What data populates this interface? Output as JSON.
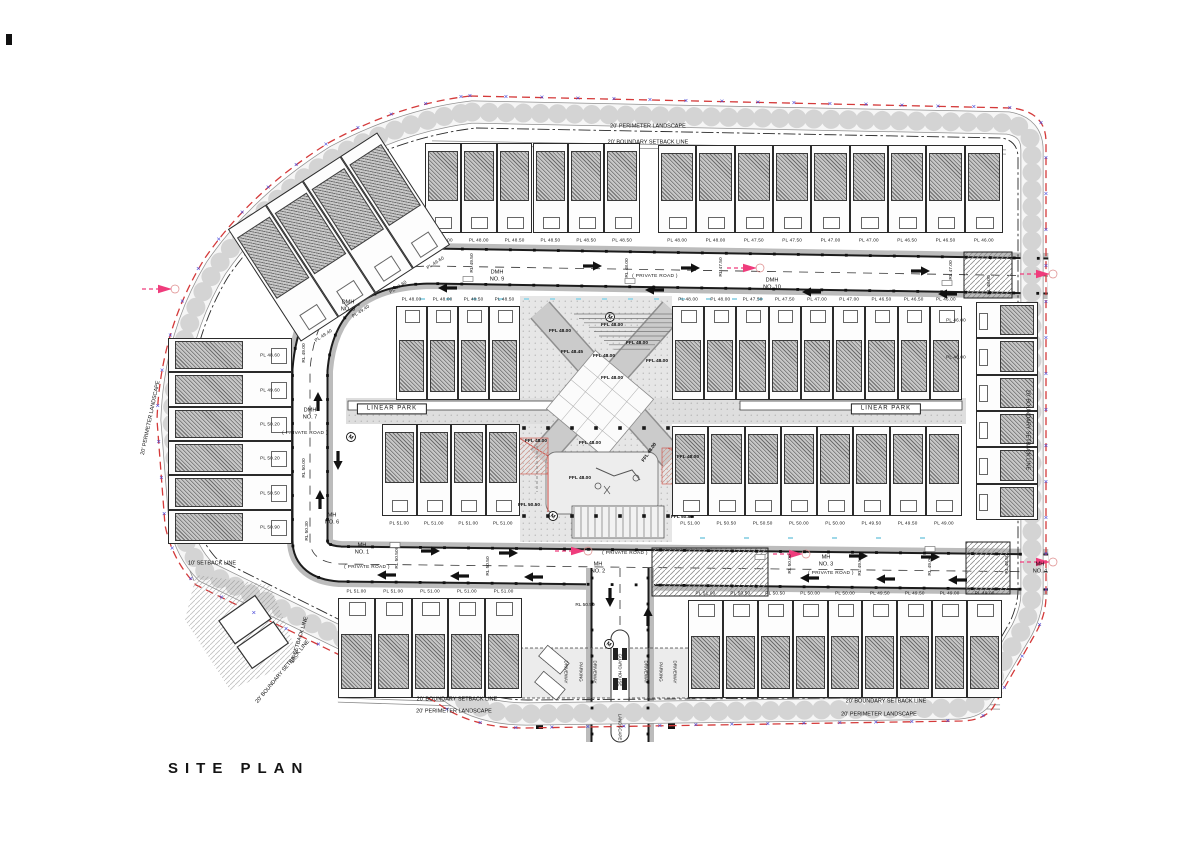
{
  "title": "SITE PLAN",
  "colors": {
    "line": "#1a1a1a",
    "boundary_red": "#d43a3a",
    "marker_blue": "#4646d8",
    "flow_pink": "#ef3c7c",
    "road_fill": "#ffffff",
    "park_fill": "#e3e3e3",
    "garden_hatch": "#c7c7c7",
    "cyan_dash": "#9fd8e8"
  },
  "boundary_marker_glyph": "×",
  "perimeter_labels": [
    {
      "text": "20' PERIMETER LANDSCAPE",
      "x": 648,
      "y": 127
    },
    {
      "text": "20' BOUNDARY SETBACK LINE",
      "x": 648,
      "y": 143
    },
    {
      "text": "20' PERIMETER LANDSCAPE",
      "x": 151,
      "y": 418,
      "rot": -78
    },
    {
      "text": "10' SETBACK LINE",
      "x": 212,
      "y": 564
    },
    {
      "text": "10' SETBACK LINE",
      "x": 300,
      "y": 640,
      "rot": -73
    },
    {
      "text": "20' BOUNDARY SETBACK LINE",
      "x": 283,
      "y": 672,
      "rot": -50
    },
    {
      "text": "20' BOUNDARY SETBACK LINE",
      "x": 457,
      "y": 700
    },
    {
      "text": "20' PERIMETER LANDSCAPE",
      "x": 454,
      "y": 712
    },
    {
      "text": "20' BOUNDARY SETBACK LINE",
      "x": 886,
      "y": 702
    },
    {
      "text": "20' PERIMETER LANDSCAPE",
      "x": 879,
      "y": 715
    },
    {
      "text": "20' BOUNDARY SETBACK LINE",
      "x": 1027,
      "y": 430,
      "rot": 90
    }
  ],
  "road_labels": {
    "manholes": [
      {
        "text": "DMH\nNO. 9",
        "x": 497,
        "y": 276
      },
      {
        "text": "DMH\nNO. 10",
        "x": 772,
        "y": 284
      },
      {
        "text": "DMH\nNO. 8",
        "x": 348,
        "y": 306
      },
      {
        "text": "DMH\nNO. 7",
        "x": 310,
        "y": 414
      },
      {
        "text": "MH\nNO. 6",
        "x": 332,
        "y": 519
      },
      {
        "text": "MH\nNO. 1",
        "x": 362,
        "y": 549
      },
      {
        "text": "MH\nNO. 2",
        "x": 598,
        "y": 568
      },
      {
        "text": "MH\nNO. 3",
        "x": 826,
        "y": 561
      },
      {
        "text": "MH\nNO. 4",
        "x": 1040,
        "y": 568
      }
    ],
    "road_names": [
      {
        "text": "( PRIVATE ROAD )",
        "x": 655,
        "y": 277
      },
      {
        "text": "( PRIVATE ROAD )",
        "x": 305,
        "y": 434
      },
      {
        "text": "( PRIVATE ROAD )",
        "x": 367,
        "y": 568
      },
      {
        "text": "( PRIVATE ROAD )",
        "x": 625,
        "y": 554
      },
      {
        "text": "( PRIVATE ROAD )",
        "x": 831,
        "y": 574
      }
    ],
    "levels": [
      {
        "text": "RL 49.50",
        "x": 473,
        "y": 263
      },
      {
        "text": "RL 48.00",
        "x": 628,
        "y": 268
      },
      {
        "text": "RL 47.50",
        "x": 722,
        "y": 267
      },
      {
        "text": "RL 47.00",
        "x": 952,
        "y": 270
      },
      {
        "text": "RL 48.00",
        "x": 990,
        "y": 285
      },
      {
        "text": "RL 49.00",
        "x": 305,
        "y": 353
      },
      {
        "text": "RL 50.00",
        "x": 305,
        "y": 468
      },
      {
        "text": "RL 50.30",
        "x": 308,
        "y": 531
      },
      {
        "text": "RL 50.50",
        "x": 398,
        "y": 559
      },
      {
        "text": "RL 50.50",
        "x": 489,
        "y": 566
      },
      {
        "text": "RL 50.00",
        "x": 791,
        "y": 564
      },
      {
        "text": "RL 49.50",
        "x": 861,
        "y": 566
      },
      {
        "text": "RL 49.00",
        "x": 931,
        "y": 566
      },
      {
        "text": "RL 48.50",
        "x": 1008,
        "y": 564
      },
      {
        "text": "RL 50.50",
        "x": 585,
        "y": 606,
        "rot": 0
      }
    ]
  },
  "park": {
    "linear_parks": [
      {
        "text": "LINEAR PARK",
        "x": 392,
        "y": 409
      },
      {
        "text": "LINEAR PARK",
        "x": 886,
        "y": 409
      }
    ],
    "ffl_labels": [
      {
        "text": "FFL 48.00",
        "x": 612,
        "y": 326
      },
      {
        "text": "FFL 48.00",
        "x": 560,
        "y": 332
      },
      {
        "text": "FFL 48.45",
        "x": 572,
        "y": 353
      },
      {
        "text": "FFL 48.00",
        "x": 604,
        "y": 357
      },
      {
        "text": "FFL 48.00",
        "x": 637,
        "y": 344
      },
      {
        "text": "FFL 48.00",
        "x": 657,
        "y": 362
      },
      {
        "text": "FFL 48.00",
        "x": 612,
        "y": 379
      },
      {
        "text": "FFL 48.00",
        "x": 536,
        "y": 442
      },
      {
        "text": "FFL 48.00",
        "x": 590,
        "y": 444
      },
      {
        "text": "FFL 48.00",
        "x": 650,
        "y": 453,
        "rot": -55
      },
      {
        "text": "FFL 48.00",
        "x": 688,
        "y": 458
      },
      {
        "text": "FFL 48.00",
        "x": 580,
        "y": 479
      },
      {
        "text": "FFL 50.50",
        "x": 529,
        "y": 506
      },
      {
        "text": "FFL 50.50",
        "x": 682,
        "y": 518
      }
    ]
  },
  "entrance": {
    "labels": [
      {
        "text": "DRIVEWAY",
        "x": 566,
        "y": 672,
        "rot": 90
      },
      {
        "text": "PARKING",
        "x": 581,
        "y": 672,
        "rot": 90
      },
      {
        "text": "DRIVEWAY",
        "x": 595,
        "y": 672,
        "rot": 90
      },
      {
        "text": "GUARD HOUSE",
        "x": 620,
        "y": 670,
        "rot": 90
      },
      {
        "text": "DRIVEWAY",
        "x": 646,
        "y": 672,
        "rot": 90
      },
      {
        "text": "PARKING",
        "x": 661,
        "y": 672,
        "rot": 90
      },
      {
        "text": "DRIVEWAY",
        "x": 675,
        "y": 672,
        "rot": 90
      },
      {
        "text": "LANDSCAPE",
        "x": 620,
        "y": 727,
        "rot": 90
      }
    ]
  },
  "plots": {
    "blocks": [
      {
        "x": 425,
        "y": 143,
        "w": 215,
        "h": 90,
        "n": 6,
        "front": "bottom",
        "labels": [
          "PL 48.00",
          "PL 48.00",
          "PL 48.50",
          "PL 48.50",
          "PL 48.50",
          "PL 48.50"
        ]
      },
      {
        "x": 658,
        "y": 145,
        "w": 345,
        "h": 88,
        "n": 9,
        "front": "bottom",
        "labels": [
          "PL 48.00",
          "PL 48.00",
          "PL 47.50",
          "PL 47.50",
          "PL 47.00",
          "PL 47.00",
          "PL 46.50",
          "PL 46.50",
          "PL 46.00"
        ]
      },
      {
        "x": 396,
        "y": 306,
        "w": 124,
        "h": 94,
        "n": 4,
        "front": "top",
        "labels": [
          "PL 48.00",
          "PL 48.00",
          "PL 48.50",
          "PL 48.50"
        ]
      },
      {
        "x": 672,
        "y": 306,
        "w": 290,
        "h": 94,
        "n": 9,
        "front": "top",
        "labels": [
          "PL 48.00",
          "PL 48.00",
          "PL 47.50",
          "PL 47.50",
          "PL 47.00",
          "PL 47.00",
          "PL 46.50",
          "PL 46.50",
          "PL 46.00"
        ]
      },
      {
        "x": 382,
        "y": 424,
        "w": 138,
        "h": 92,
        "n": 4,
        "front": "bottom",
        "labels": [
          "PL 51.00",
          "PL 51.00",
          "PL 51.00",
          "PL 51.00"
        ]
      },
      {
        "x": 672,
        "y": 426,
        "w": 290,
        "h": 90,
        "n": 8,
        "front": "bottom",
        "labels": [
          "PL 51.00",
          "PL 50.50",
          "PL 50.50",
          "PL 50.00",
          "PL 50.00",
          "PL 49.50",
          "PL 49.50",
          "PL 49.00"
        ]
      },
      {
        "x": 338,
        "y": 598,
        "w": 184,
        "h": 100,
        "n": 5,
        "front": "top",
        "labels": [
          "PL 51.00",
          "PL 51.00",
          "PL 51.00",
          "PL 51.00",
          "PL 51.00"
        ]
      },
      {
        "x": 688,
        "y": 600,
        "w": 314,
        "h": 98,
        "n": 9,
        "front": "top",
        "labels": [
          "PL 51.00",
          "PL 50.50",
          "PL 50.50",
          "PL 50.00",
          "PL 50.00",
          "PL 49.50",
          "PL 49.50",
          "PL 49.00",
          "PL 49.00"
        ]
      },
      {
        "x": 168,
        "y": 338,
        "w": 124,
        "h": 206,
        "n": 6,
        "front": "right",
        "labels": [
          "PL 48.60",
          "PL 49.60",
          "PL 50.20",
          "PL 50.20",
          "PL 50.50",
          "PL 50.90"
        ]
      },
      {
        "x": 976,
        "y": 302,
        "w": 62,
        "h": 218,
        "n": 6,
        "front": "left",
        "labels": [
          "PL 46.00",
          "PL 46.00",
          "",
          "",
          "",
          ""
        ]
      },
      {
        "x": 250,
        "y": 170,
        "w": 178,
        "h": 134,
        "n": 4,
        "front": "bottom",
        "rot": -33,
        "labels": [
          "PL 49.40",
          "PL 49.40",
          "PL 49.60",
          "PL 49.60"
        ]
      }
    ]
  },
  "traffic_arrows": [
    {
      "d": "r",
      "x": 390,
      "y": 263
    },
    {
      "d": "r",
      "x": 602,
      "y": 266
    },
    {
      "d": "r",
      "x": 700,
      "y": 268
    },
    {
      "d": "r",
      "x": 930,
      "y": 271
    },
    {
      "d": "l",
      "x": 438,
      "y": 288
    },
    {
      "d": "l",
      "x": 645,
      "y": 290
    },
    {
      "d": "l",
      "x": 802,
      "y": 292
    },
    {
      "d": "l",
      "x": 938,
      "y": 294
    },
    {
      "d": "r",
      "x": 440,
      "y": 551
    },
    {
      "d": "r",
      "x": 518,
      "y": 553
    },
    {
      "d": "r",
      "x": 868,
      "y": 556
    },
    {
      "d": "r",
      "x": 940,
      "y": 557
    },
    {
      "d": "l",
      "x": 377,
      "y": 575
    },
    {
      "d": "l",
      "x": 450,
      "y": 576
    },
    {
      "d": "l",
      "x": 524,
      "y": 577
    },
    {
      "d": "l",
      "x": 800,
      "y": 578
    },
    {
      "d": "l",
      "x": 876,
      "y": 579
    },
    {
      "d": "l",
      "x": 948,
      "y": 580
    },
    {
      "d": "u",
      "x": 318,
      "y": 392
    },
    {
      "d": "u",
      "x": 320,
      "y": 490
    },
    {
      "d": "d",
      "x": 338,
      "y": 470
    },
    {
      "d": "u",
      "x": 648,
      "y": 607
    },
    {
      "d": "d",
      "x": 610,
      "y": 607
    }
  ],
  "flow_arrows": [
    {
      "x": 757,
      "y": 268
    },
    {
      "x": 172,
      "y": 289
    },
    {
      "x": 585,
      "y": 551
    },
    {
      "x": 803,
      "y": 554
    },
    {
      "x": 1050,
      "y": 274
    },
    {
      "x": 1050,
      "y": 562
    }
  ],
  "manhole_symbols": [
    {
      "glyph": "M",
      "x": 610,
      "y": 317
    },
    {
      "glyph": "M",
      "x": 351,
      "y": 437
    },
    {
      "glyph": "M",
      "x": 609,
      "y": 644
    },
    {
      "glyph": "M",
      "x": 553,
      "y": 516
    }
  ]
}
